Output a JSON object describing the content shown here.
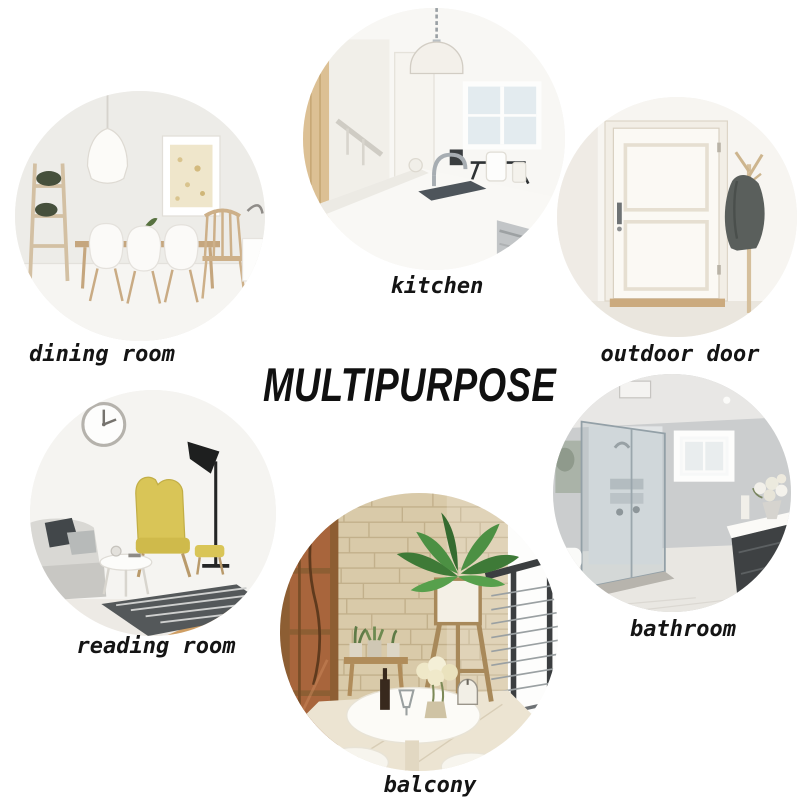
{
  "title": "MULTIPURPOSE",
  "rooms": [
    {
      "id": "dining-room",
      "label": "dining room"
    },
    {
      "id": "kitchen",
      "label": "kitchen"
    },
    {
      "id": "outdoor-door",
      "label": "outdoor door"
    },
    {
      "id": "reading-room",
      "label": "reading room"
    },
    {
      "id": "balcony",
      "label": "balcony"
    },
    {
      "id": "bathroom",
      "label": "bathroom"
    }
  ],
  "colors": {
    "background": "#ffffff",
    "text": "#141414",
    "armchair_yellow": "#d9c557",
    "wood_tone": "#c9a87c",
    "plant_green": "#3e7a37",
    "stone_wall": "#d9caa9",
    "jacket_gray": "#5a5f5c",
    "glass_gray": "#aebcc4"
  }
}
